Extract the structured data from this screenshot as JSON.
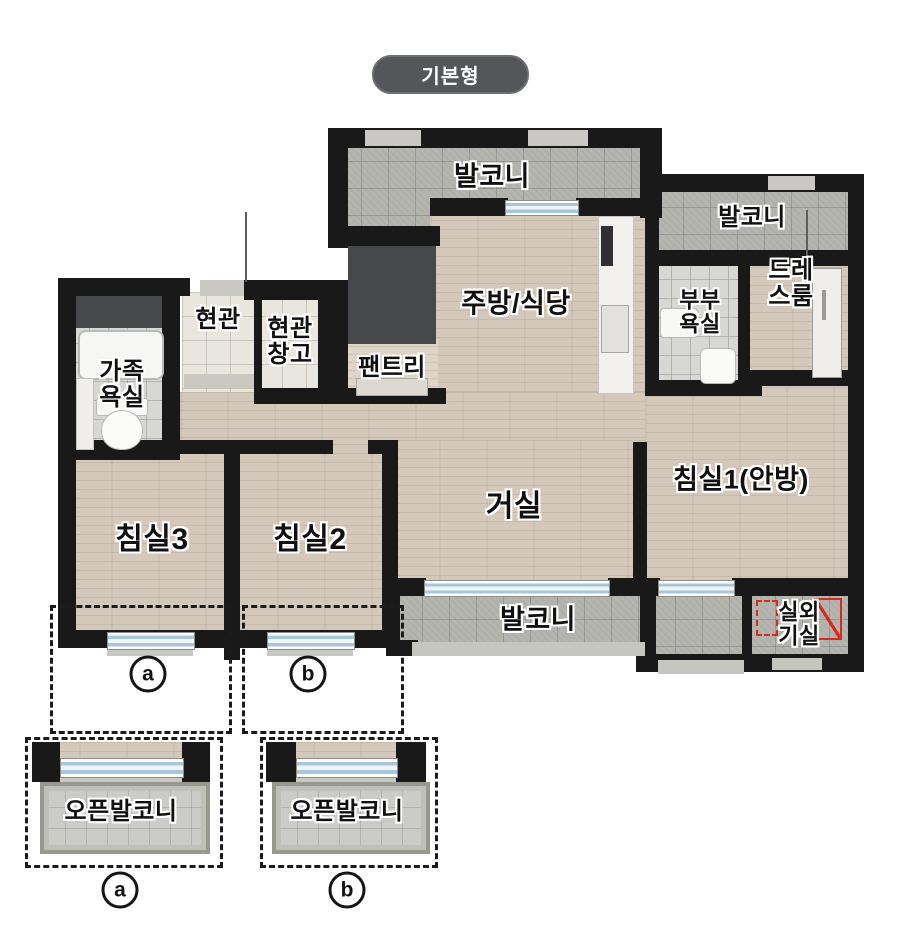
{
  "badge": {
    "label": "기본형"
  },
  "rooms": {
    "balcony_top": {
      "label": "발코니"
    },
    "balcony_top_right": {
      "label": "발코니"
    },
    "kitchen": {
      "label": "주방/식당"
    },
    "entrance": {
      "label": "현관"
    },
    "entrance_storage": {
      "label": "현관\n창고"
    },
    "pantry": {
      "label": "팬트리"
    },
    "family_bath": {
      "label": "가족\n욕실"
    },
    "master_bath": {
      "label": "부부\n욕실"
    },
    "dress_room": {
      "label": "드레\n스룸"
    },
    "bedroom3": {
      "label": "침실3"
    },
    "bedroom2": {
      "label": "침실2"
    },
    "living": {
      "label": "거실"
    },
    "bedroom1": {
      "label": "침실1(안방)"
    },
    "balcony_bottom": {
      "label": "발코니"
    },
    "outdoor_unit": {
      "label": "실외\n기실"
    },
    "open_balcony_a": {
      "label": "오픈발코니"
    },
    "open_balcony_b": {
      "label": "오픈발코니"
    }
  },
  "markers": {
    "plan_a": "a",
    "plan_b": "b",
    "detail_a": "a",
    "detail_b": "b"
  },
  "colors": {
    "wall": "#191919",
    "wood": "#d3c8b9",
    "tile": "#b1b1ac",
    "accent_red": "#d62a1f",
    "badge_bg": "#55565a"
  }
}
